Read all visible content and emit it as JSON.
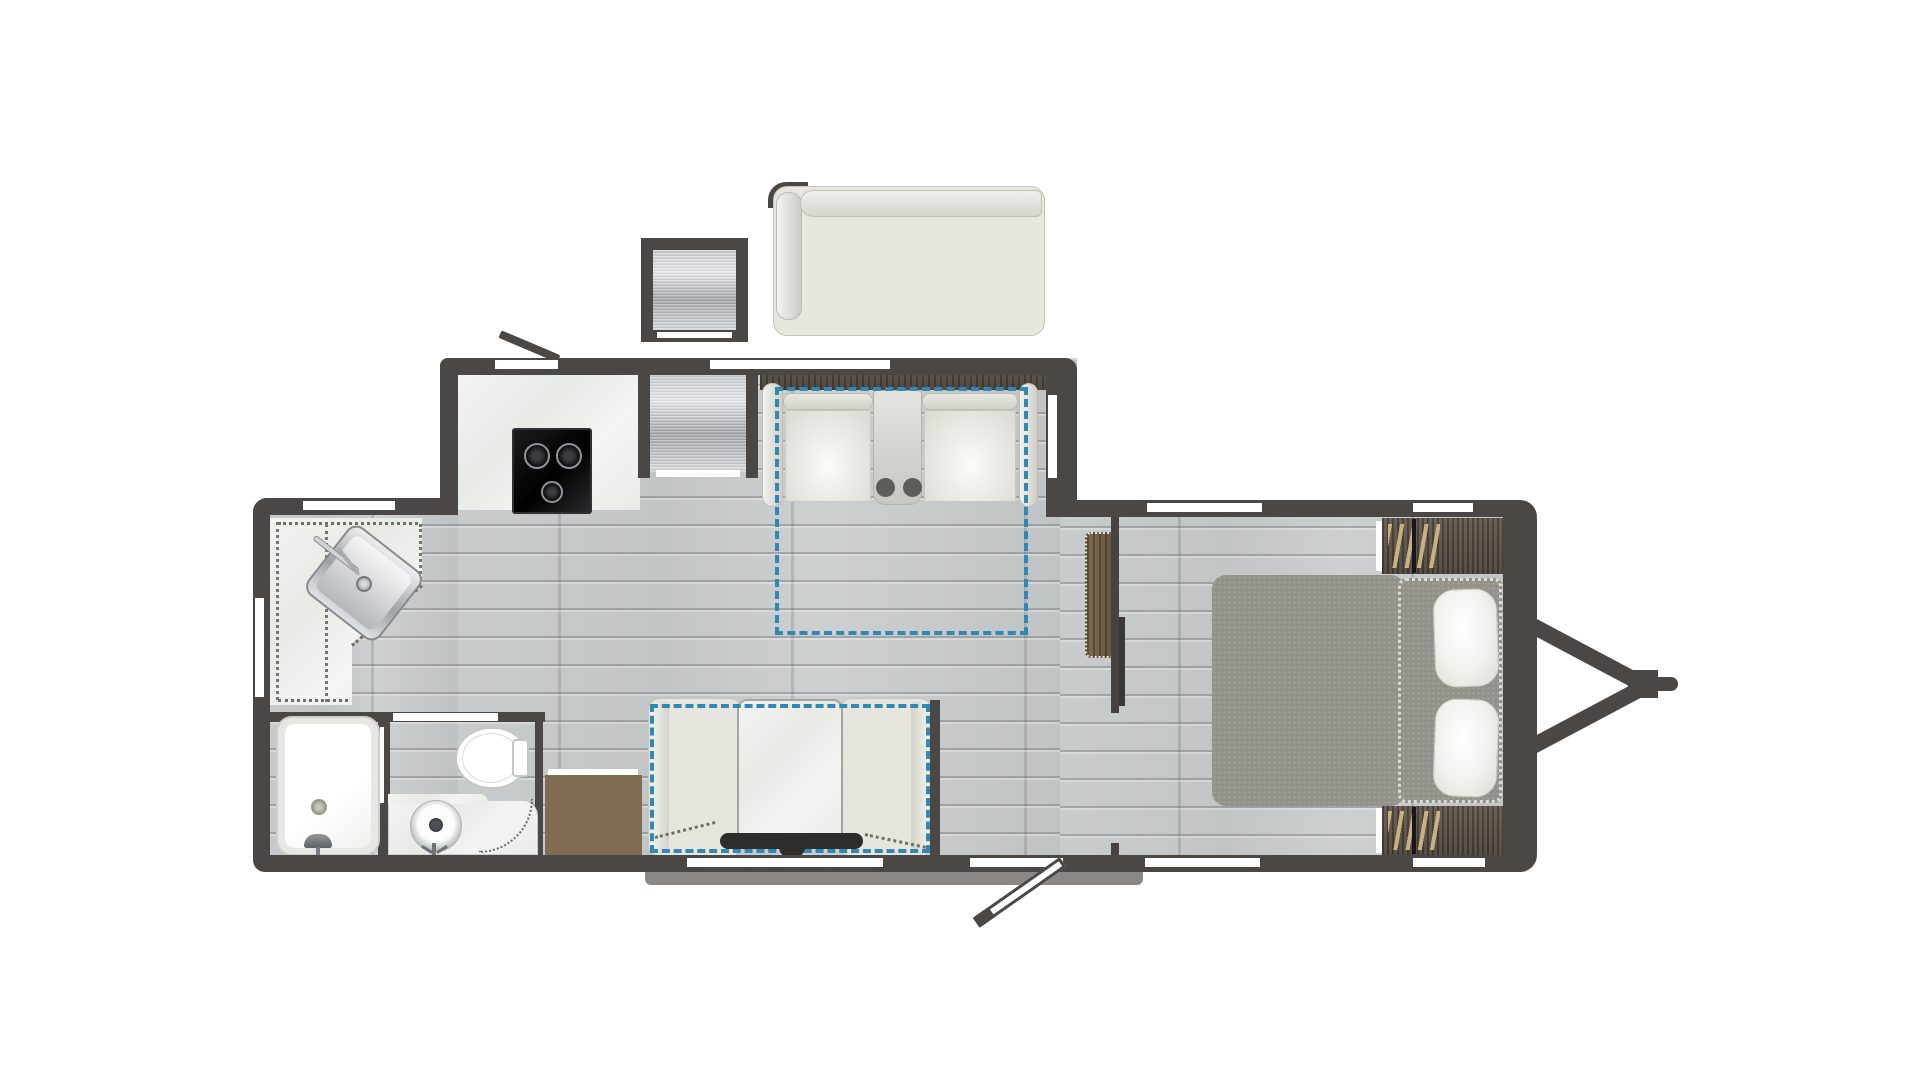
{
  "title": "Travel trailer RV floor plan, top-down view",
  "palette": {
    "wall": "#4a4745",
    "floor_wood": "#c7cacb",
    "counter_marble": "#eff0ed",
    "stainless": "#b9bcbe",
    "slideout_dash_blue": "#3188b4",
    "upholstery": "#e6e6df",
    "mattress_gray": "#92918a",
    "cabinet_wood": "#7d6a50",
    "hanger_tan": "#c9b083",
    "step_dark": "#2e2d2b"
  },
  "legend": {
    "dashed_blue_rectangles": "slide-out / optional furniture footprints",
    "white_wall_gaps": "windows and door openings",
    "dotted_white_border": "bed extension with pillows",
    "dotted_gray_lines": "counter trim and door swing paths"
  },
  "items": {
    "sofa": {
      "label": "Sofa (in top slide-out)"
    },
    "exterior_cabinet": {
      "label": "Exterior appliance / outside kitchen box"
    },
    "refrigerator": {
      "label": "Refrigerator"
    },
    "cooktop": {
      "label": "3-burner cooktop",
      "burners": 3
    },
    "kitchen_counter": {
      "label": "Kitchen counter"
    },
    "kitchen_sink": {
      "label": "Stainless kitchen sink with faucet"
    },
    "theater_seating": {
      "label": "Theater seating with center console",
      "cupholders": 2,
      "seats": 2
    },
    "wardrobe": {
      "label": "Wardrobe cabinet"
    },
    "bed": {
      "label": "Bed with dotted extension and two pillows",
      "pillows": 2
    },
    "bed_cabinet_top": {
      "label": "Bedside wardrobe with hangers (top)"
    },
    "bed_cabinet_bottom": {
      "label": "Bedside wardrobe with hangers (bottom)"
    },
    "dinette": {
      "label": "Dinette: two benches and table (in bottom slide-out)"
    },
    "entry_step": {
      "label": "Entry step with handle"
    },
    "dresser": {
      "label": "Wood dresser cabinet"
    },
    "bathtub": {
      "label": "Bathtub / shower with faucet and drain"
    },
    "toilet": {
      "label": "Toilet with tank"
    },
    "vanity": {
      "label": "Bathroom vanity with vessel sink"
    },
    "door_top": {
      "label": "Entry door, open (top wall)"
    },
    "door_bottom": {
      "label": "Entry door, open (bottom wall)"
    },
    "hitch": {
      "label": "A-frame tongue hitch with coupler"
    },
    "divider_wall": {
      "label": "Bedroom divider wall with pocket door"
    }
  },
  "counts": {
    "windows": 9,
    "door_openings": 2,
    "slide_out_indicators": 2
  }
}
